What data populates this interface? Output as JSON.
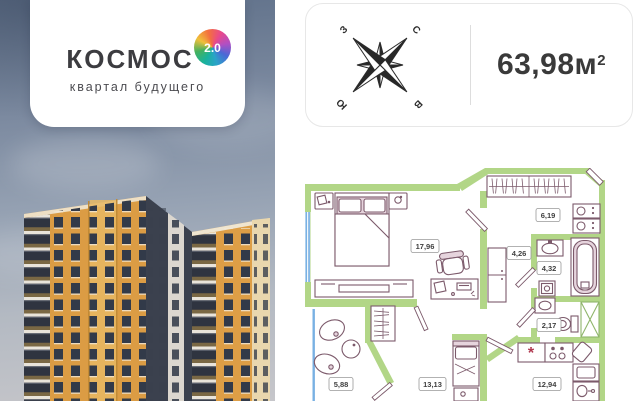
{
  "logo_card": {
    "brand": "КОСМОС",
    "badge": "2.0",
    "tagline": "квартал будущего"
  },
  "info_card": {
    "area_value": "63,98",
    "area_unit": "м",
    "area_sup": "2",
    "compass": {
      "n": "С",
      "e": "В",
      "s": "Ю",
      "w": "З"
    }
  },
  "floor_plan": {
    "room_areas": [
      "17,96",
      "6,19",
      "4,26",
      "4,32",
      "2,17",
      "5,88",
      "13,13",
      "12,94"
    ],
    "kitchen_symbol": "*",
    "total_area_m2": "63,98"
  },
  "colors": {
    "wall_green": "#b2d687",
    "furniture_outline": "#7c5a6b",
    "furniture_pink": "#e6d4dd",
    "window_blue": "#79b1e3",
    "facade_orange": "#db9c44",
    "facade_cream": "#e9d7ae",
    "tower_dark": "#3b414e",
    "text_dark": "#3a3a3a"
  }
}
